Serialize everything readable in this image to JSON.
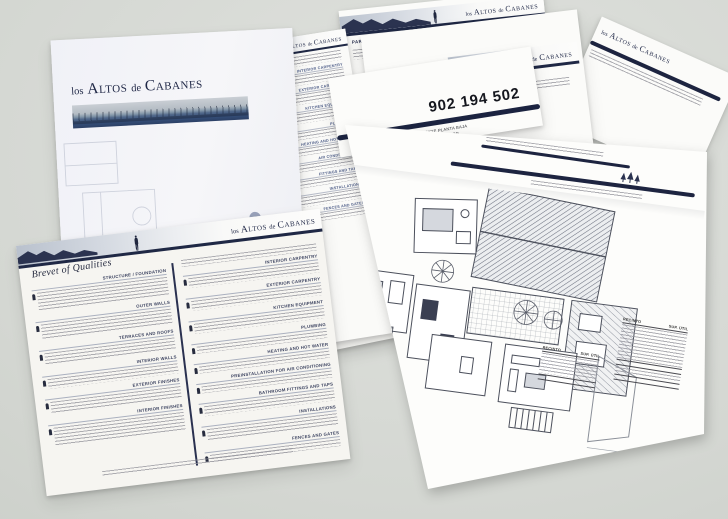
{
  "brand": {
    "part1": "los",
    "part2": "Altos",
    "part3": "de",
    "part4": "Cabanes"
  },
  "qualities": {
    "script_heading": "Brevet of Qualities",
    "left_sections": [
      "STRUCTURE / FOUNDATION",
      "OUTER WALLS",
      "TERRACES AND ROOFS",
      "INTERIOR WALLS",
      "EXTERIOR FINISHES",
      "INTERIOR FINISHES"
    ],
    "right_sections": [
      "INTERIOR CARPENTRY",
      "EXTERIOR CARPENTRY",
      "KITCHEN EQUIPMENT",
      "PLUMBING",
      "HEATING AND HOT WATER",
      "PREINSTALLATION FOR AIR CONDITIONING",
      "BATHROOM FITTINGS AND TAPS",
      "INSTALLATIONS",
      "FENCES AND GATES"
    ]
  },
  "mid_sheet": {
    "headings": [
      "INTERIOR CARPENTRY",
      "EXTERIOR CARPENTRY",
      "KITCHEN EQUIPMENT",
      "PLUMBING",
      "HEATING AND HOT WATER",
      "AIR CONDITIONING",
      "FITTINGS AND TAPS",
      "INSTALLATIONS",
      "FENCES AND GATES"
    ]
  },
  "plan_sheet": {
    "phone": "902 194 502",
    "captions": [
      "DISTRIBUCIÓN Y SUPERFICIE PLANTA BAJA",
      "LAYOUT AND AREA OF GROUND FLOOR",
      "AUFTEILUNG UND FLÄCHE ERDGESCHOSS"
    ],
    "area_table": {
      "col_room": "RECINTO",
      "col_area": "SUP. ÚTIL"
    }
  },
  "fan_sheets": {
    "parcela_label": "PARCELA Y MODELO"
  }
}
